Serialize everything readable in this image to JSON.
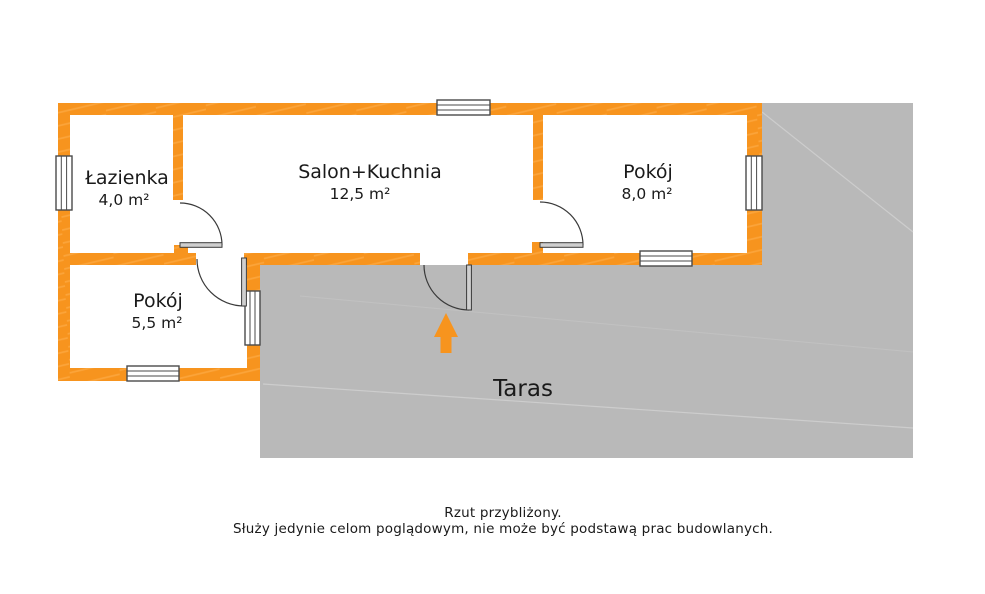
{
  "plan": {
    "rooms": [
      {
        "name": "Łazienka",
        "area": "4,0 m²"
      },
      {
        "name": "Salon+Kuchnia",
        "area": "12,5 m²"
      },
      {
        "name": "Pokój",
        "area": "8,0 m²"
      },
      {
        "name": "Pokój",
        "area": "5,5 m²"
      }
    ],
    "terrace_label": "Taras"
  },
  "footer": {
    "line1": "Rzut przybliżony.",
    "line2": "Służy jedynie celom poglądowym, nie może być podstawą prac budowlanych."
  },
  "colors": {
    "wall_orange": "#F7941E",
    "wall_streak": "#FFB95E",
    "terrace_gray": "#B9B9B9",
    "arrow_orange": "#F7941E"
  }
}
